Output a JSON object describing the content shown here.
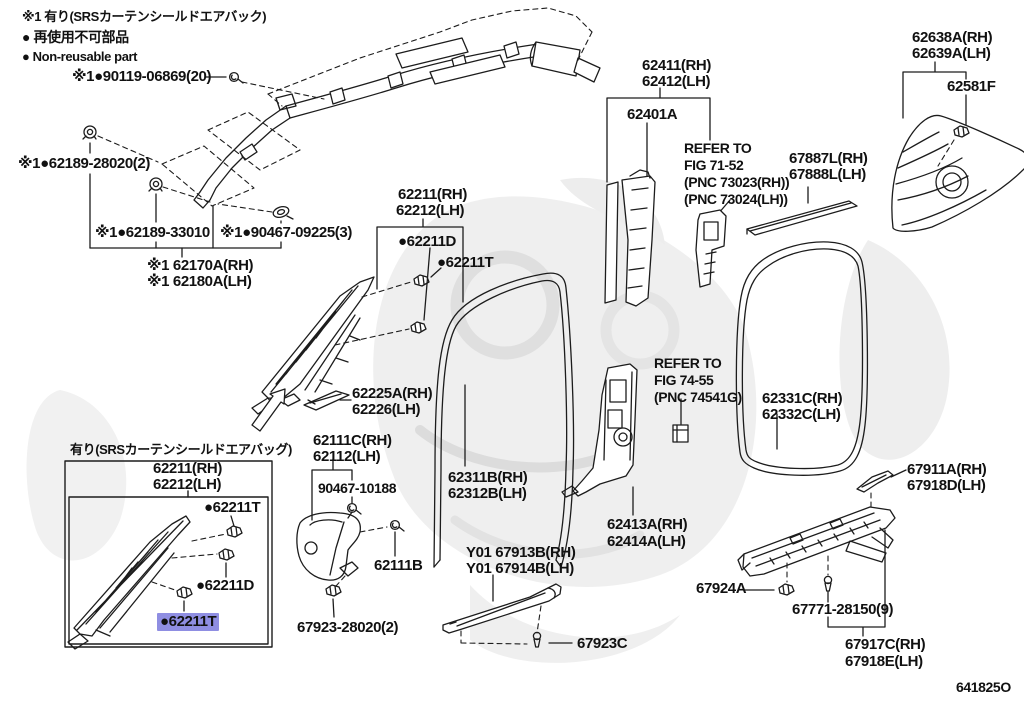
{
  "colors": {
    "ink": "#1c1c1c",
    "highlight": "#8f8ee2",
    "watermark": "#ececec"
  },
  "diagram_code": "641825O",
  "legend": {
    "srs_note": "※1 有り(SRSカーテンシールドエアバック)",
    "nonreusable_ja": "● 再使用不可部品",
    "nonreusable_en": "● Non-reusable part"
  },
  "parts": {
    "p90119": "※1●90119-06869(20)",
    "p62189_28020": "※1●62189-28020(2)",
    "p62189_33010": "※1●62189-33010",
    "p90467_09225": "※1●90467-09225(3)",
    "p62170a": "※1 62170A(RH)",
    "p62180a": "※1 62180A(LH)",
    "p62211": "62211(RH)",
    "p62212": "62212(LH)",
    "p62211d": "●62211D",
    "p62211t": "●62211T",
    "p62225a": "62225A(RH)",
    "p62226": "62226(LH)",
    "p62111c": "62111C(RH)",
    "p62112": "62112(LH)",
    "p90467_10188": "90467-10188",
    "p62311b": "62311B(RH)",
    "p62312b": "62312B(LH)",
    "p62111b": "62111B",
    "p67923_28020": "67923-28020(2)",
    "p67913b": "Y01 67913B(RH)",
    "p67914b": "Y01 67914B(LH)",
    "p67923c": "67923C",
    "p62411": "62411(RH)",
    "p62412": "62412(LH)",
    "p62401a": "62401A",
    "p67887l": "67887L(RH)",
    "p67888l": "67888L(LH)",
    "p62638a": "62638A(RH)",
    "p62639a": "62639A(LH)",
    "p62581f": "62581F",
    "p62331c": "62331C(RH)",
    "p62332c": "62332C(LH)",
    "p62413a": "62413A(RH)",
    "p62414a": "62414A(LH)",
    "p67911a": "67911A(RH)",
    "p67918d": "67918D(LH)",
    "p67924a": "67924A",
    "p67771": "67771-28150(9)",
    "p67917c": "67917C(RH)",
    "p67918e": "67918E(LH)"
  },
  "refer1": {
    "l1": "REFER TO",
    "l2": "FIG 71-52",
    "l3": "(PNC 73023(RH))",
    "l4": "(PNC 73024(LH))"
  },
  "refer2": {
    "l1": "REFER TO",
    "l2": "FIG 74-55",
    "l3": "(PNC 74541G)"
  },
  "detail_box": {
    "title": "有り(SRSカーテンシールドエアバッグ)",
    "p62211": "62211(RH)",
    "p62212": "62212(LH)",
    "t_top": "●62211T",
    "d_mid": "●62211D",
    "t_highlighted": "●62211T"
  }
}
